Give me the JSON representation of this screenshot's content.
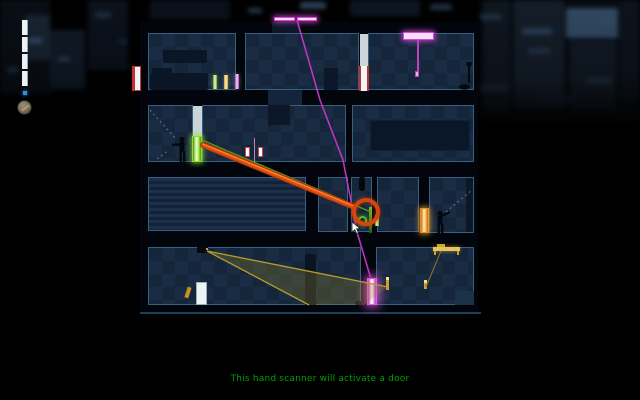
{
  "game": {
    "tooltip": "This hand scanner will activate a door",
    "tooltip_color": "#00a000"
  },
  "hud": {
    "jump_meter": {
      "segments": 4,
      "color": "#edf1f3"
    },
    "indicator_dot_color": "#2e8fe0",
    "gadget_icon": "clock-gadget"
  },
  "level": {
    "guards": 2,
    "selection_ring_color": "#d8450c",
    "wire_colors": {
      "crosslink_drag": "#cc430a",
      "green_link": "#4f9815",
      "magenta_link": "#c835c8",
      "camera_cone": "#b89b28"
    },
    "doors": [
      {
        "name": "entry-door",
        "color": "white-red"
      },
      {
        "name": "upper-red-door",
        "color": "white-red"
      },
      {
        "name": "green-door",
        "color": "green"
      },
      {
        "name": "orange-door",
        "color": "orange"
      },
      {
        "name": "magenta-door",
        "color": "magenta"
      },
      {
        "name": "white-door",
        "color": "white"
      }
    ],
    "devices": [
      {
        "name": "hand-scanner",
        "highlighted": true
      },
      {
        "name": "security-camera"
      },
      {
        "name": "roof-light-bar",
        "color": "magenta"
      },
      {
        "name": "ceiling-scanner",
        "color": "magenta"
      },
      {
        "name": "wall-sconces",
        "color": "red"
      },
      {
        "name": "light-tubes",
        "colors": [
          "green",
          "orange",
          "magenta"
        ]
      },
      {
        "name": "ceiling-light-fixture",
        "color": "yellow"
      }
    ]
  }
}
